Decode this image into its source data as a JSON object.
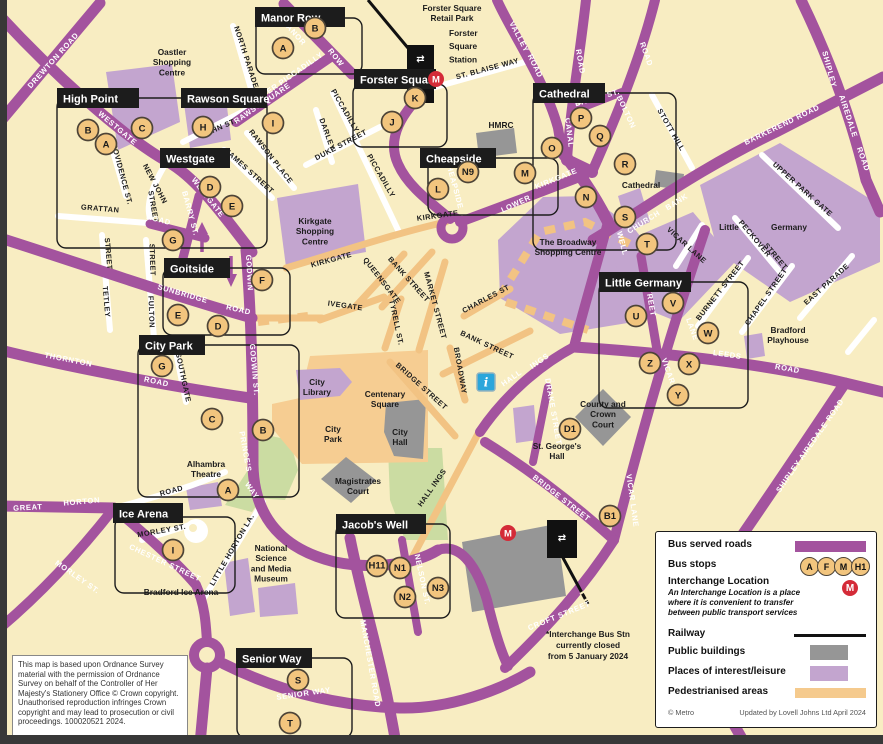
{
  "colors": {
    "background": "#F8EDC2",
    "bus_road_purple": "#A3539E",
    "places_of_interest": "#C3A5CF",
    "public_building_grey": "#969696",
    "pedestrianised_orange": "#F5CA8D",
    "park_green": "#CBDCA2",
    "railway_black": "#111111",
    "bus_stop_fill": "#F2C57E",
    "bus_stop_border": "#4D4437",
    "interchange_red": "#D42B38",
    "info_blue": "#2BA6DB"
  },
  "map": {
    "zones": [
      {
        "label": "Manor Row",
        "lx": 255,
        "ly": 7,
        "lw": 90,
        "box": [
          256,
          18,
          106,
          56
        ]
      },
      {
        "label": "High Point",
        "lx": 57,
        "ly": 88,
        "lw": 82,
        "box": [
          57,
          98,
          210,
          150
        ]
      },
      {
        "label": "Rawson Square",
        "lx": 181,
        "ly": 88,
        "lw": 86,
        "box": null
      },
      {
        "label": "Westgate",
        "lx": 160,
        "ly": 148,
        "lw": 70,
        "box": null
      },
      {
        "label": "Forster Square",
        "lx": 354,
        "ly": 69,
        "lw": 82,
        "box": [
          353,
          84,
          94,
          63
        ]
      },
      {
        "label": "Cheapside",
        "lx": 420,
        "ly": 148,
        "lw": 76,
        "box": [
          428,
          158,
          130,
          57
        ]
      },
      {
        "label": "Cathedral",
        "lx": 533,
        "ly": 83,
        "lw": 72,
        "box": [
          533,
          93,
          143,
          157
        ]
      },
      {
        "label": "Goitside",
        "lx": 164,
        "ly": 258,
        "lw": 66,
        "box": [
          163,
          268,
          127,
          67
        ]
      },
      {
        "label": "Little Germany",
        "lx": 599,
        "ly": 272,
        "lw": 92,
        "box": [
          599,
          282,
          149,
          126
        ]
      },
      {
        "label": "City Park",
        "lx": 139,
        "ly": 335,
        "lw": 66,
        "box": [
          138,
          345,
          161,
          152
        ]
      },
      {
        "label": "Ice Arena",
        "lx": 113,
        "ly": 503,
        "lw": 70,
        "box": [
          115,
          517,
          120,
          76
        ]
      },
      {
        "label": "Jacob's Well",
        "lx": 336,
        "ly": 514,
        "lw": 90,
        "box": [
          336,
          524,
          114,
          94
        ]
      },
      {
        "label": "Senior Way",
        "lx": 236,
        "ly": 648,
        "lw": 76,
        "box": [
          237,
          658,
          115,
          80
        ]
      }
    ],
    "purple_road_labels": [
      [
        "DREWTON ROAD",
        55,
        62,
        -48
      ],
      [
        "WESTGATE",
        116,
        130,
        40
      ],
      [
        "WESTGATE",
        206,
        199,
        52
      ],
      [
        "MANOR",
        292,
        34,
        48
      ],
      [
        "ROW",
        334,
        59,
        52
      ],
      [
        "RAWSON",
        252,
        113,
        -35
      ],
      [
        "SQUARE",
        276,
        97,
        -35
      ],
      [
        "UPPER PICCADILLY",
        289,
        80,
        -35
      ],
      [
        "BARRY ST.",
        188,
        214,
        75
      ],
      [
        "ROAD",
        158,
        222,
        15
      ],
      [
        "GODWIN",
        247,
        273,
        87
      ],
      [
        "GODWIN ST.",
        252,
        370,
        85
      ],
      [
        "PRINCE'S",
        243,
        452,
        80
      ],
      [
        "WAY",
        250,
        492,
        55
      ],
      [
        "SUNBRIDGE",
        182,
        296,
        16
      ],
      [
        "ROAD",
        238,
        312,
        13
      ],
      [
        "THORNTON",
        68,
        362,
        11
      ],
      [
        "ROAD",
        156,
        384,
        12
      ],
      [
        "GREAT",
        28,
        510,
        -3
      ],
      [
        "HORTON",
        82,
        504,
        -5
      ],
      [
        "MORLEY ST.",
        76,
        579,
        35
      ],
      [
        "CHESTER STREET",
        164,
        565,
        25
      ],
      [
        "SENIOR WAY",
        304,
        696,
        -8
      ],
      [
        "MANCHESTER ROAD",
        368,
        664,
        80
      ],
      [
        "NELSON ST.",
        420,
        580,
        78
      ],
      [
        "CROFT STREET",
        560,
        618,
        -22
      ],
      [
        "HALL",
        513,
        380,
        -35
      ],
      [
        "INGS",
        541,
        363,
        -35
      ],
      [
        "BRIDGE STREET",
        560,
        500,
        38
      ],
      [
        "DRAKE STREET",
        551,
        412,
        80
      ],
      [
        "VICAR LANE",
        630,
        501,
        82
      ],
      [
        "LANE",
        690,
        330,
        70
      ],
      [
        "VICAR",
        666,
        372,
        70
      ],
      [
        "LEEDS",
        727,
        357,
        8
      ],
      [
        "ROAD",
        787,
        371,
        10
      ],
      [
        "WELL",
        620,
        244,
        75
      ],
      [
        "CHURCH",
        645,
        224,
        -32
      ],
      [
        "BANK",
        678,
        204,
        -32
      ],
      [
        "BARKEREND ROAD",
        783,
        127,
        -26
      ],
      [
        "BOLTON",
        624,
        113,
        65
      ],
      [
        "ROAD",
        644,
        55,
        70
      ],
      [
        "CANAL",
        567,
        133,
        83
      ],
      [
        "ROAD",
        578,
        62,
        80
      ],
      [
        "VALLEY",
        517,
        38,
        62
      ],
      [
        "ROAD",
        533,
        67,
        65
      ],
      [
        "BALME ST.",
        598,
        100,
        -16
      ],
      [
        "LOWER",
        517,
        206,
        -25
      ],
      [
        "KIRKGATE",
        557,
        181,
        -22
      ],
      [
        "CHEAPSIDE",
        452,
        185,
        75
      ],
      [
        "STREET",
        648,
        300,
        80
      ],
      [
        "SHIPLEY",
        827,
        70,
        75
      ],
      [
        "AIREDALE",
        846,
        117,
        72
      ],
      [
        "ROAD",
        861,
        160,
        70
      ],
      [
        "SHIPLEY AIREDALE ROAD",
        812,
        447,
        -55
      ]
    ],
    "white_street_labels": [
      [
        "NORTH PARADE",
        244,
        58,
        72
      ],
      [
        "NEW JOHN",
        153,
        185,
        62
      ],
      [
        "STREET",
        151,
        207,
        80
      ],
      [
        "JOHN ST.",
        220,
        130,
        -24
      ],
      [
        "RAWSON PLACE",
        269,
        158,
        52
      ],
      [
        "JAMES STREET",
        248,
        173,
        42
      ],
      [
        "DARLEY",
        325,
        135,
        70
      ],
      [
        "DUKE STREET",
        342,
        147,
        -28
      ],
      [
        "PICCADILLY",
        343,
        112,
        60
      ],
      [
        "PICCADILLY",
        379,
        177,
        60
      ],
      [
        "ST. BLAISE WAY",
        488,
        71,
        -15
      ],
      [
        "STOTT HILL",
        669,
        131,
        60
      ],
      [
        "GRATTAN",
        100,
        211,
        5
      ],
      [
        "PROVIDENCE ST.",
        119,
        172,
        75
      ],
      [
        "STREET",
        106,
        254,
        85
      ],
      [
        "TETLEY",
        104,
        302,
        85
      ],
      [
        "STREET",
        150,
        260,
        88
      ],
      [
        "FULTON",
        149,
        312,
        88
      ],
      [
        "SOUTHGATE",
        181,
        378,
        78
      ],
      [
        "MORLEY ST.",
        162,
        533,
        -10
      ],
      [
        "LITTLE HORTON LA.",
        234,
        551,
        -60
      ],
      [
        "ROAD",
        172,
        493,
        -15
      ],
      [
        "CHARLES ST",
        487,
        301,
        -28
      ],
      [
        "BROADWAY",
        458,
        371,
        80
      ],
      [
        "MARKET STREET",
        433,
        306,
        75
      ],
      [
        "BANK STREET",
        407,
        281,
        48
      ],
      [
        "BANK STREET",
        486,
        347,
        25
      ],
      [
        "QUEENSGATE",
        380,
        282,
        52
      ],
      [
        "IVEGATE",
        345,
        308,
        8
      ],
      [
        "TYRELL ST.",
        394,
        323,
        78
      ],
      [
        "KIRKGATE",
        332,
        262,
        -15
      ],
      [
        "KIRKGATE",
        438,
        218,
        -8
      ],
      [
        "BRIDGE STREET",
        420,
        388,
        42
      ],
      [
        "HALL INGS",
        434,
        489,
        -55
      ],
      [
        "VICAR LANE",
        685,
        247,
        42
      ],
      [
        "BURNETT STREET",
        722,
        292,
        -52
      ],
      [
        "CHAPEL STREET",
        768,
        298,
        -55
      ],
      [
        "EAST PARADE",
        828,
        286,
        -42
      ],
      [
        "PECKOVER",
        753,
        240,
        50
      ],
      [
        "STREET",
        774,
        258,
        50
      ],
      [
        "UPPER PARK GATE",
        801,
        191,
        42
      ]
    ],
    "place_labels": [
      {
        "t": "Forster Square\nRetail Park",
        "x": 452,
        "y": 11,
        "s": 8.5,
        "a": "middle"
      },
      {
        "t": "Forster\nSquare\nStation",
        "x": 449,
        "y": 36,
        "s": 11,
        "a": "start"
      },
      {
        "t": "Oastler\nShopping\nCentre",
        "x": 172,
        "y": 55,
        "s": 8.5,
        "a": "middle"
      },
      {
        "t": "HMRC",
        "x": 501,
        "y": 128,
        "s": 8.5,
        "a": "middle"
      },
      {
        "t": "Cathedral",
        "x": 641,
        "y": 188,
        "s": 8.5,
        "a": "middle"
      },
      {
        "t": "Little",
        "x": 729,
        "y": 230,
        "s": 8.5,
        "a": "middle"
      },
      {
        "t": "Germany",
        "x": 789,
        "y": 230,
        "s": 8.5,
        "a": "middle"
      },
      {
        "t": "Kirkgate\nShopping\nCentre",
        "x": 315,
        "y": 224,
        "s": 8.5,
        "a": "middle"
      },
      {
        "t": "The Broadway\nShopping Centre",
        "x": 568,
        "y": 245,
        "s": 8.5,
        "a": "middle"
      },
      {
        "t": "Bradford\nPlayhouse",
        "x": 788,
        "y": 333,
        "s": 8.5,
        "a": "middle"
      },
      {
        "t": "City\nLibrary",
        "x": 317,
        "y": 385,
        "s": 8.5,
        "a": "middle"
      },
      {
        "t": "Centenary\nSquare",
        "x": 385,
        "y": 397,
        "s": 8.5,
        "a": "middle"
      },
      {
        "t": "City\nPark",
        "x": 333,
        "y": 432,
        "s": 8.5,
        "a": "middle"
      },
      {
        "t": "City\nHall",
        "x": 400,
        "y": 435,
        "s": 8.5,
        "a": "middle"
      },
      {
        "t": "Magistrates\nCourt",
        "x": 358,
        "y": 484,
        "s": 8.5,
        "a": "middle"
      },
      {
        "t": "County and\nCrown\nCourt",
        "x": 603,
        "y": 407,
        "s": 8.5,
        "a": "middle"
      },
      {
        "t": "St. George's\nHall",
        "x": 557,
        "y": 449,
        "s": 8.5,
        "a": "middle"
      },
      {
        "t": "Alhambra\nTheatre",
        "x": 206,
        "y": 467,
        "s": 8.5,
        "a": "middle"
      },
      {
        "t": "National\nScience\nand Media\nMuseum",
        "x": 271,
        "y": 551,
        "s": 8.5,
        "a": "middle"
      },
      {
        "t": "Bradford Ice Arena",
        "x": 181,
        "y": 595,
        "s": 8.5,
        "a": "middle"
      }
    ],
    "bus_stops": [
      [
        "B",
        315,
        28
      ],
      [
        "A",
        283,
        48
      ],
      [
        "B",
        88,
        130
      ],
      [
        "A",
        106,
        144
      ],
      [
        "C",
        142,
        128
      ],
      [
        "H",
        203,
        127
      ],
      [
        "I",
        273,
        123
      ],
      [
        "D",
        210,
        187
      ],
      [
        "E",
        232,
        206
      ],
      [
        "G",
        173,
        240
      ],
      [
        "K",
        415,
        98
      ],
      [
        "J",
        392,
        122
      ],
      [
        "L",
        438,
        189
      ],
      [
        "N9",
        468,
        172
      ],
      [
        "M",
        525,
        173
      ],
      [
        "O",
        552,
        148
      ],
      [
        "P",
        581,
        118
      ],
      [
        "Q",
        600,
        136
      ],
      [
        "R",
        625,
        164
      ],
      [
        "N",
        586,
        197
      ],
      [
        "S",
        625,
        217
      ],
      [
        "T",
        647,
        244
      ],
      [
        "F",
        262,
        280
      ],
      [
        "E",
        178,
        315
      ],
      [
        "D",
        218,
        326
      ],
      [
        "G",
        162,
        366
      ],
      [
        "C",
        212,
        419
      ],
      [
        "B",
        263,
        430
      ],
      [
        "A",
        228,
        490
      ],
      [
        "I",
        173,
        550
      ],
      [
        "U",
        636,
        316
      ],
      [
        "V",
        673,
        303
      ],
      [
        "W",
        708,
        333
      ],
      [
        "Z",
        650,
        363
      ],
      [
        "X",
        689,
        364
      ],
      [
        "Y",
        678,
        395
      ],
      [
        "D1",
        570,
        429
      ],
      [
        "B1",
        610,
        516
      ],
      [
        "H11",
        377,
        566
      ],
      [
        "N1",
        400,
        568
      ],
      [
        "N2",
        405,
        597
      ],
      [
        "N3",
        438,
        588
      ],
      [
        "S",
        298,
        680
      ],
      [
        "T",
        290,
        723
      ]
    ],
    "interchange_icons": [
      [
        436,
        79
      ],
      [
        508,
        533
      ]
    ],
    "info_icon": {
      "x": 486,
      "y": 382,
      "glyph": "i"
    },
    "station_symbol": "⇄",
    "note": "*Interchange Bus Stn\ncurrently closed\nfrom 5 January 2024",
    "copyright": "This map is based upon Ordnance Survey material with the permission of Ordnance Survey on behalf of the Controller of Her Majesty's Stationery Office © Crown copyright. Unauthorised reproduction infringes Crown copyright and may lead to prosecution or civil proceedings. 100020521 2024."
  },
  "legend": {
    "rows": [
      "Bus served roads",
      "Bus stops",
      "Interchange Location",
      "Railway",
      "Public buildings",
      "Places of interest/leisure",
      "Pedestrianised areas"
    ],
    "interchange_desc": "An Interchange Location is a place\nwhere it is convenient to transfer\nbetween public transport services",
    "stops": [
      "A",
      "F",
      "M",
      "H1"
    ],
    "footer_left": "© Metro",
    "footer_right": "Updated by Lovell Johns Ltd April 2024"
  }
}
